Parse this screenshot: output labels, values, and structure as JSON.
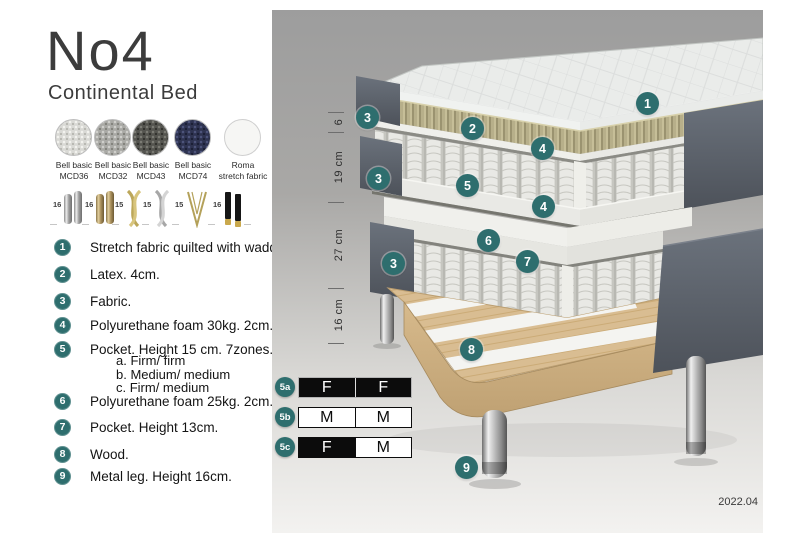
{
  "header": {
    "title": "No4",
    "subtitle": "Continental Bed"
  },
  "fabrics": [
    {
      "line1": "Bell basic",
      "line2": "MCD36"
    },
    {
      "line1": "Bell basic",
      "line2": "MCD32"
    },
    {
      "line1": "Bell basic",
      "line2": "MCD43"
    },
    {
      "line1": "Bell basic",
      "line2": "MCD74"
    },
    {
      "line1": "Roma",
      "line2": "stretch fabric"
    }
  ],
  "legs": [
    {
      "size": "16",
      "type": "cylinder-silver"
    },
    {
      "size": "16",
      "type": "cylinder-brass"
    },
    {
      "size": "15",
      "type": "twisted-gold"
    },
    {
      "size": "15",
      "type": "twisted-silver"
    },
    {
      "size": "15",
      "type": "hairpin-gold"
    },
    {
      "size": "16",
      "type": "tapered-black-gold"
    }
  ],
  "parts": [
    {
      "num": "1",
      "text": "Stretch fabric quilted with wadding."
    },
    {
      "num": "2",
      "text": "Latex. 4cm."
    },
    {
      "num": "3",
      "text": "Fabric."
    },
    {
      "num": "4",
      "text": "Polyurethane foam 30kg. 2cm."
    },
    {
      "num": "5",
      "text": "Pocket. Height 15 cm. 7zones. Option:",
      "options": [
        "a. Firm/ firm",
        "b. Medium/ medium",
        "c. Firm/ medium"
      ]
    },
    {
      "num": "6",
      "text": "Polyurethane foam 25kg. 2cm."
    },
    {
      "num": "7",
      "text": "Pocket. Height 13cm."
    },
    {
      "num": "8",
      "text": "Wood."
    },
    {
      "num": "9",
      "text": "Metal leg. Height 16cm."
    }
  ],
  "diagram": {
    "badge_labels": [
      "1",
      "2",
      "3",
      "4",
      "5",
      "6",
      "7",
      "8",
      "9"
    ],
    "dimensions": [
      {
        "label": "6"
      },
      {
        "label": "19 cm"
      },
      {
        "label": "27 cm"
      },
      {
        "label": "16 cm"
      }
    ],
    "firmness": [
      {
        "id": "5a",
        "left": {
          "letter": "F",
          "style": "dark"
        },
        "right": {
          "letter": "F",
          "style": "dark"
        }
      },
      {
        "id": "5b",
        "left": {
          "letter": "M",
          "style": "light"
        },
        "right": {
          "letter": "M",
          "style": "light"
        }
      },
      {
        "id": "5c",
        "left": {
          "letter": "F",
          "style": "dark"
        },
        "right": {
          "letter": "M",
          "style": "light"
        }
      }
    ],
    "version": "2022.04"
  },
  "colors": {
    "accent_teal": "#2E6E6E",
    "panel_top": "#9D9D9D",
    "panel_bottom": "#F4F3F1",
    "wood": "#D9BD92",
    "latex": "#B7AF8A",
    "fabric_dark": "#565C64",
    "table_black": "#0C0C0C"
  }
}
